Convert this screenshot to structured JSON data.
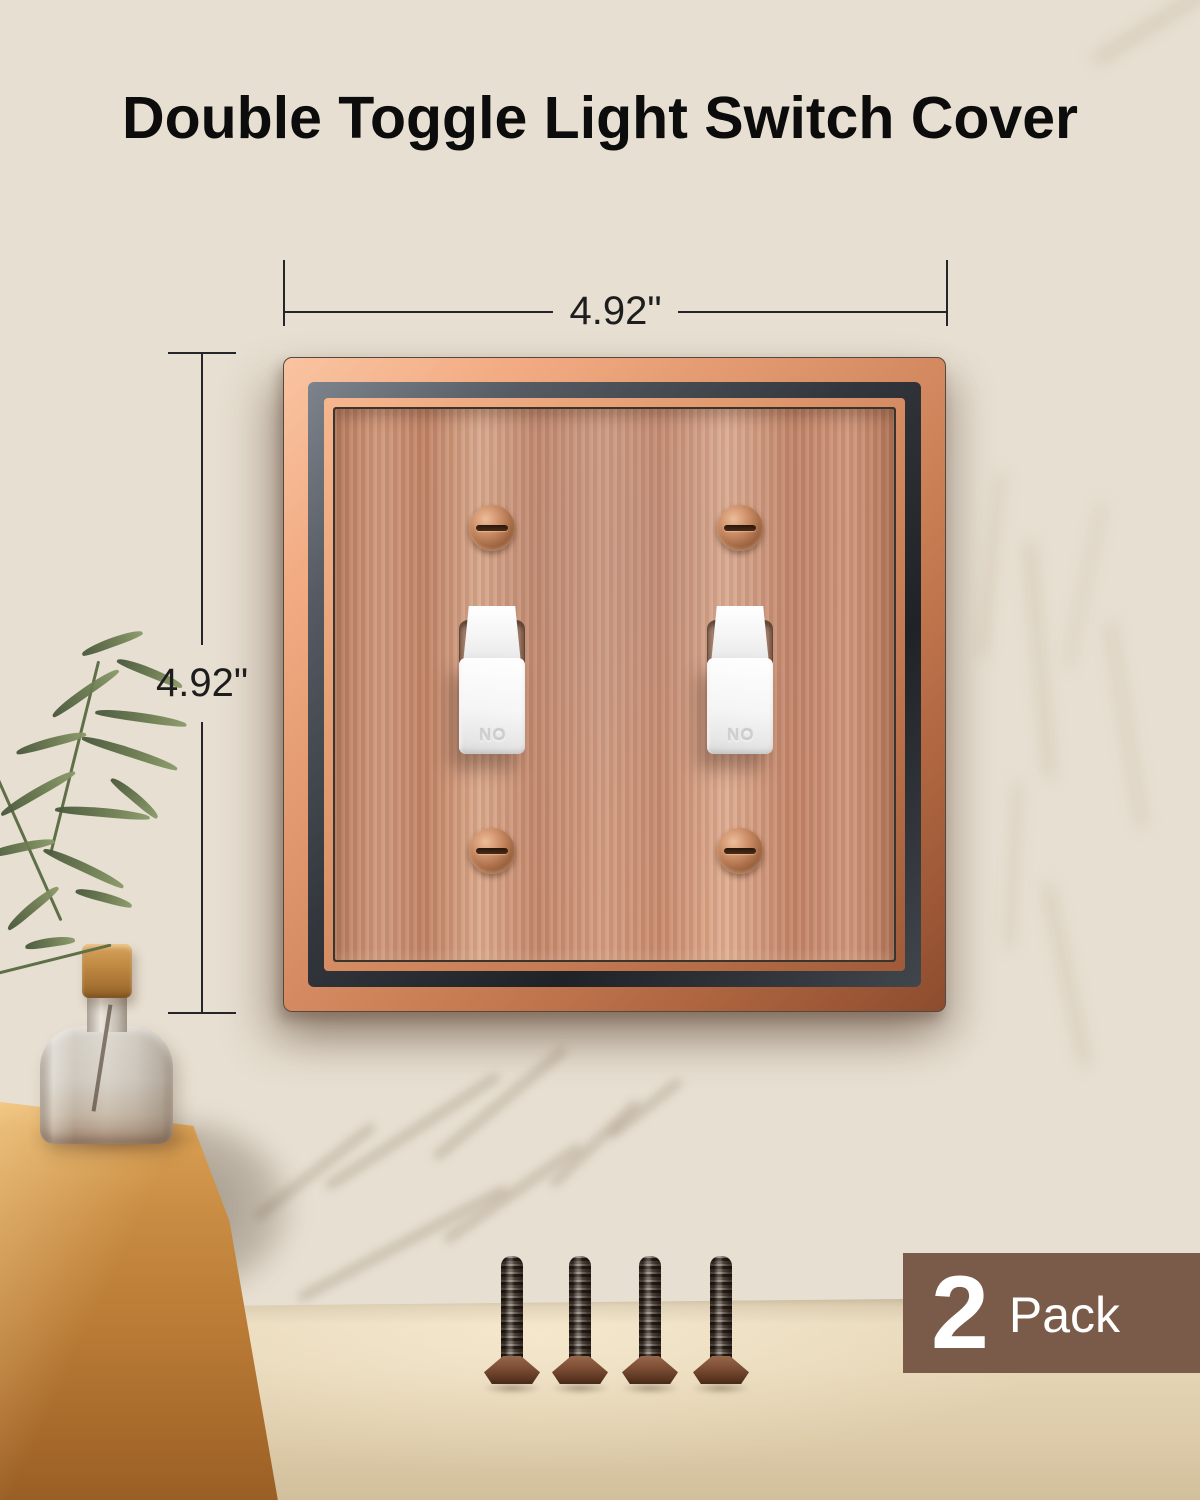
{
  "page": {
    "title": "Double Toggle Light Switch Cover"
  },
  "dimension_annotations": {
    "width": "4.92\"",
    "height": "4.92\""
  },
  "switch_plate": {
    "toggle_embossed_label": "ON",
    "toggle_count": 2,
    "plate_screw_count": 4
  },
  "included_hardware": {
    "loose_screw_count": 4
  },
  "badge": {
    "count": "2",
    "label": "Pack"
  },
  "colors": {
    "title_text": "#0c0c0c",
    "dimension_line": "#26262a",
    "badge_background": "#7a5b49",
    "badge_text": "#ffffff",
    "copper_frame_light": "#f2ab82",
    "copper_frame_dark": "#8d4c2e",
    "frame_groove": "#33373d",
    "plate_field": "#c98d6f",
    "toggle_white": "#f5f5f5",
    "wall": "#e7dfd1",
    "counter": "#e3d3b5",
    "tray_wood": "#c98c43",
    "plant_green": "#5f6f48"
  }
}
